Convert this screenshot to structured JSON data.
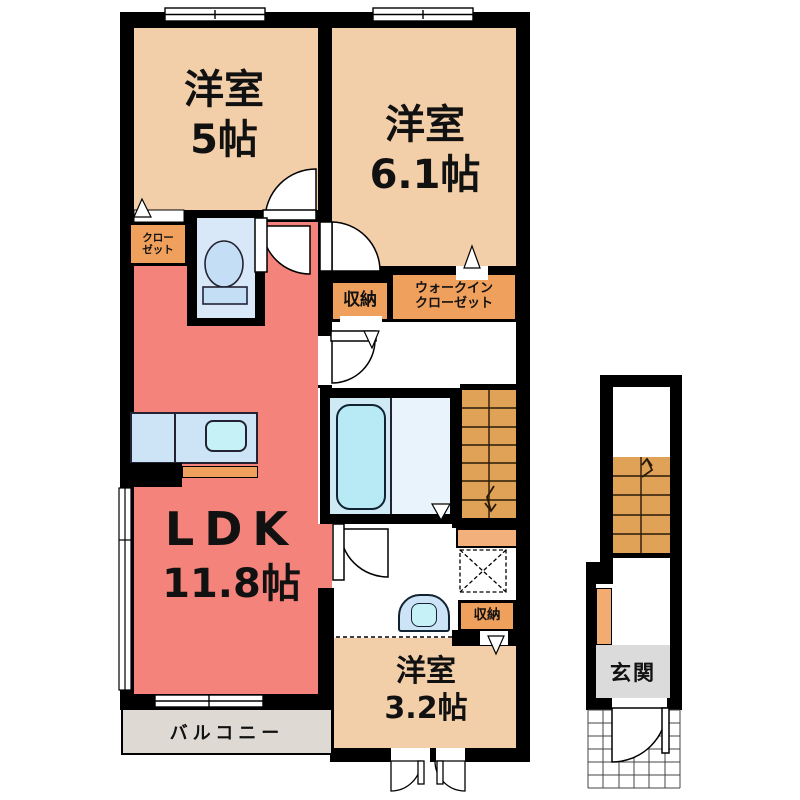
{
  "rooms": {
    "room5": {
      "name": "洋室",
      "size": "5帖"
    },
    "room61": {
      "name": "洋室",
      "size": "6.1帖"
    },
    "ldk": {
      "name": "LDK",
      "size": "11.8帖"
    },
    "room32": {
      "name": "洋室",
      "size": "3.2帖"
    }
  },
  "storage": {
    "closet_line1": "クロー",
    "closet_line2": "ゼット",
    "storage_top": "収納",
    "wic_line1": "ウォークイン",
    "wic_line2": "クローゼット",
    "storage_bottom": "収納"
  },
  "areas": {
    "balcony": "バルコニー",
    "entrance": "玄関"
  },
  "colors": {
    "wall": "#000000",
    "room-peach": "#F2CEA9",
    "ldk-salmon": "#F4837B",
    "storage-orange": "#EFA05C",
    "stairs-orange": "#DFA257",
    "stairs-light": "#F2B17C",
    "cabinet-orange": "#F2AC72",
    "water-blue": "#CDE3F6",
    "water-blue-light": "#C6F1F6",
    "toilet-room-blue": "#D9E8F8",
    "tub-blue": "#B7EAF4",
    "bath-left": "#CFE9F5",
    "bath-right": "#E9F3FB",
    "balcony-gray": "#DEDAD3",
    "genkan-gray": "#DBDBDB"
  }
}
